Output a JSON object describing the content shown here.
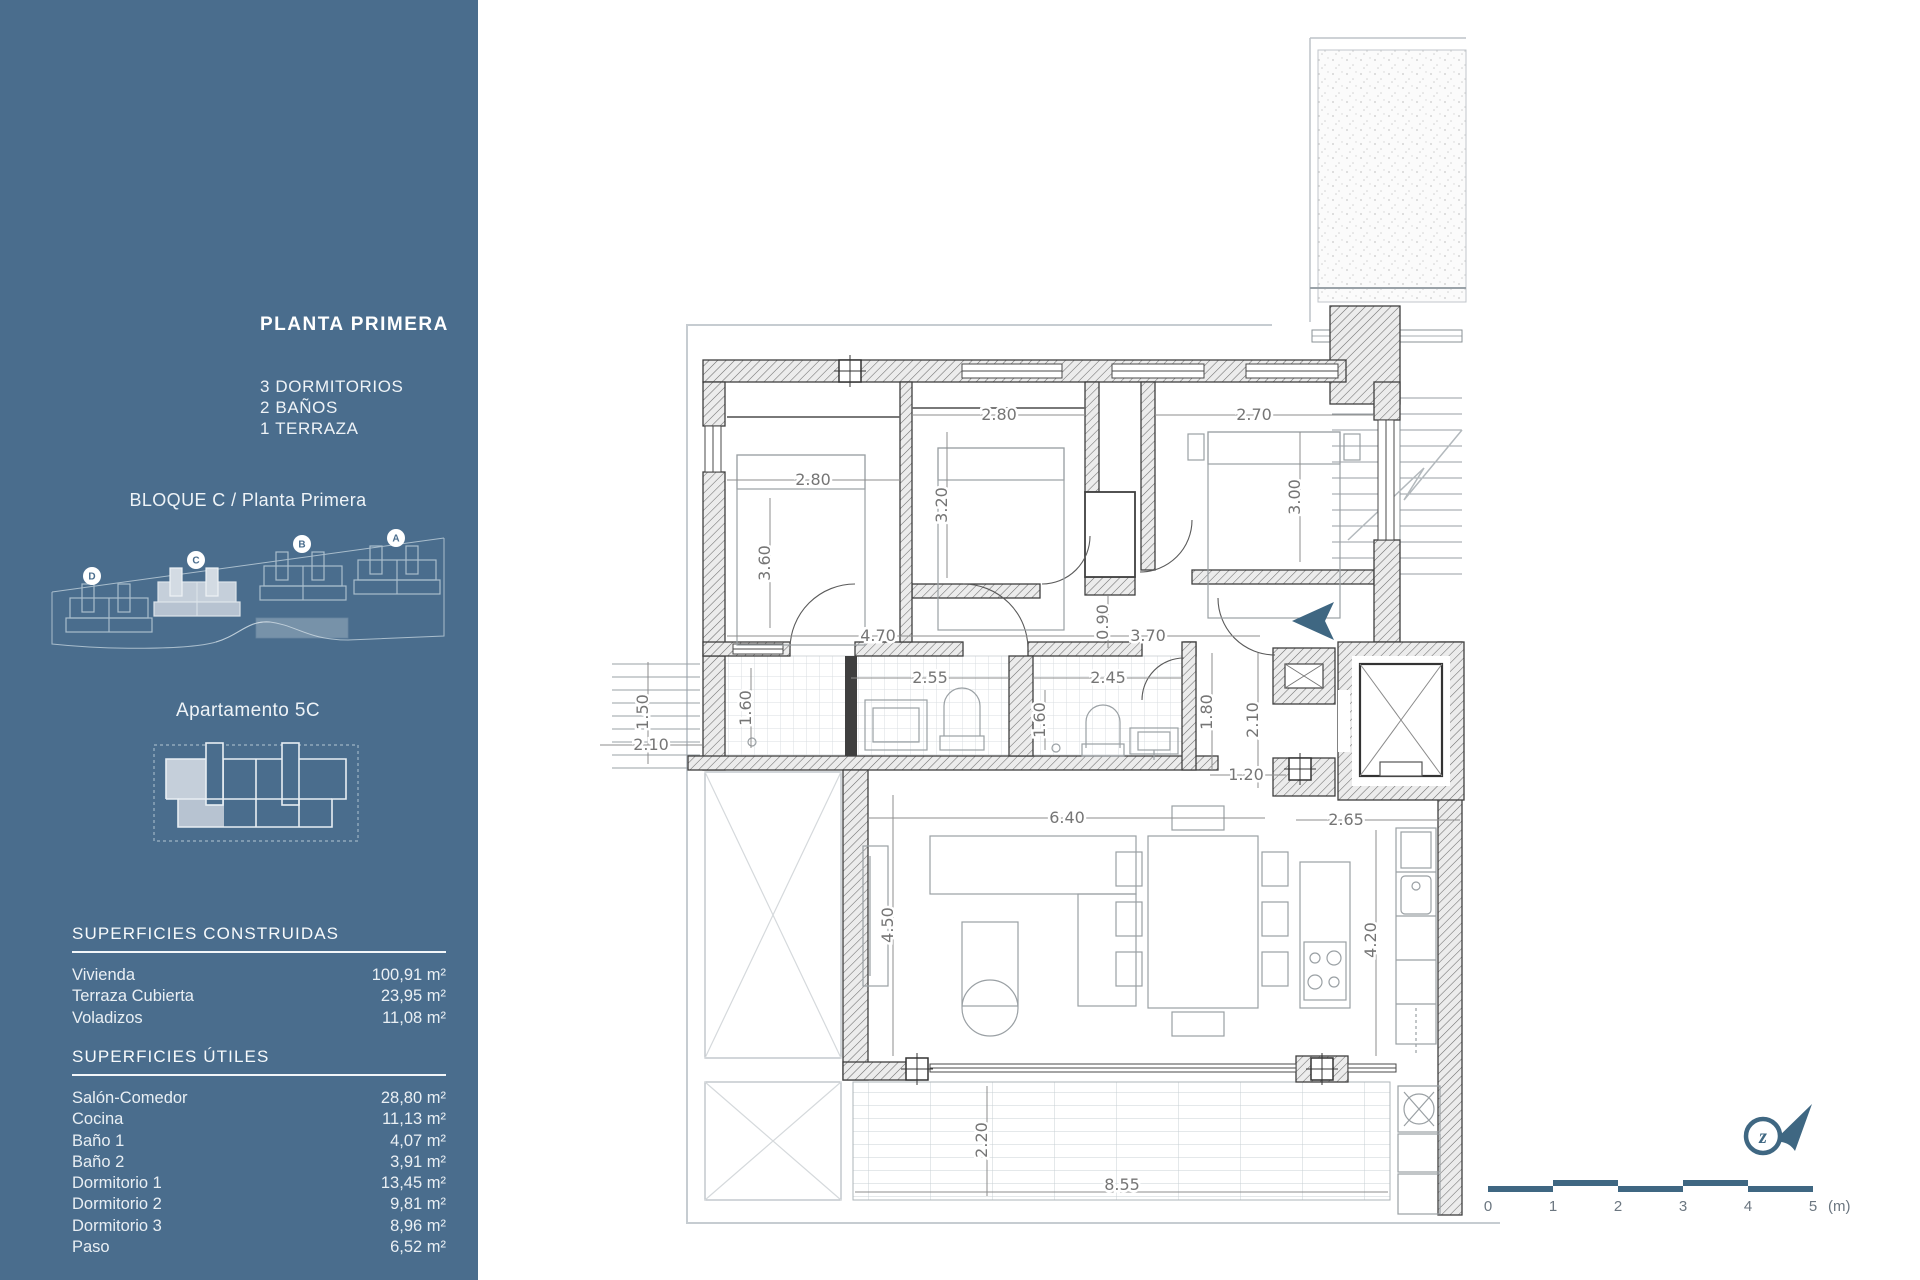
{
  "sidebar": {
    "title": "PLANTA PRIMERA",
    "features": [
      "3 DORMITORIOS",
      "2 BAÑOS",
      "1 TERRAZA"
    ],
    "block_label": "BLOQUE C / Planta Primera",
    "site_blocks": [
      "D",
      "C",
      "B",
      "A"
    ],
    "apartment_label": "Apartamento 5C",
    "constructed": {
      "heading": "SUPERFICIES CONSTRUIDAS",
      "rows": [
        {
          "label": "Vivienda",
          "value": "100,91 m²"
        },
        {
          "label": "Terraza Cubierta",
          "value": "23,95 m²"
        },
        {
          "label": "Voladizos",
          "value": "11,08 m²"
        }
      ]
    },
    "useful": {
      "heading": "SUPERFICIES ÚTILES",
      "rows": [
        {
          "label": "Salón-Comedor",
          "value": "28,80 m²"
        },
        {
          "label": "Cocina",
          "value": "11,13 m²"
        },
        {
          "label": "Baño 1",
          "value": "4,07 m²"
        },
        {
          "label": "Baño 2",
          "value": "3,91 m²"
        },
        {
          "label": "Dormitorio 1",
          "value": "13,45 m²"
        },
        {
          "label": "Dormitorio 2",
          "value": "9,81 m²"
        },
        {
          "label": "Dormitorio 3",
          "value": "8,96 m²"
        },
        {
          "label": "Paso",
          "value": "6,52 m²"
        }
      ]
    }
  },
  "plan": {
    "dims": {
      "d1w": "2.80",
      "d1h": "3.60",
      "d2w": "2.80",
      "d2h": "3.20",
      "d3w": "2.70",
      "d3h": "3.00",
      "hall_left": "4.70",
      "hall_right": "3.70",
      "vestibule": "0.90",
      "bath1_w": "2.55",
      "bath1_h": "1.60",
      "bath2_w": "2.45",
      "bath2_h": "1.60",
      "stairs_rise": "1.50",
      "stairs_run": "2.10",
      "entry_d": "1.80",
      "entry_w": "1.20",
      "lobby": "2.10",
      "kitchen_pass": "2.65",
      "living_w": "6.40",
      "living_d": "4.50",
      "kitchen_d": "4.20",
      "terrace_d": "2.20",
      "terrace_w": "8.55"
    },
    "north_letter": "z"
  },
  "scalebar": {
    "ticks": [
      "0",
      "1",
      "2",
      "3",
      "4",
      "5"
    ],
    "unit": "(m)"
  },
  "colors": {
    "sidebar_bg": "#4a6d8d",
    "accent": "#3f6782",
    "wall": "#3f3f3f",
    "dim_text": "#757575",
    "site_line": "#a9bdcc",
    "highlight_fill": "#c5cfda"
  }
}
